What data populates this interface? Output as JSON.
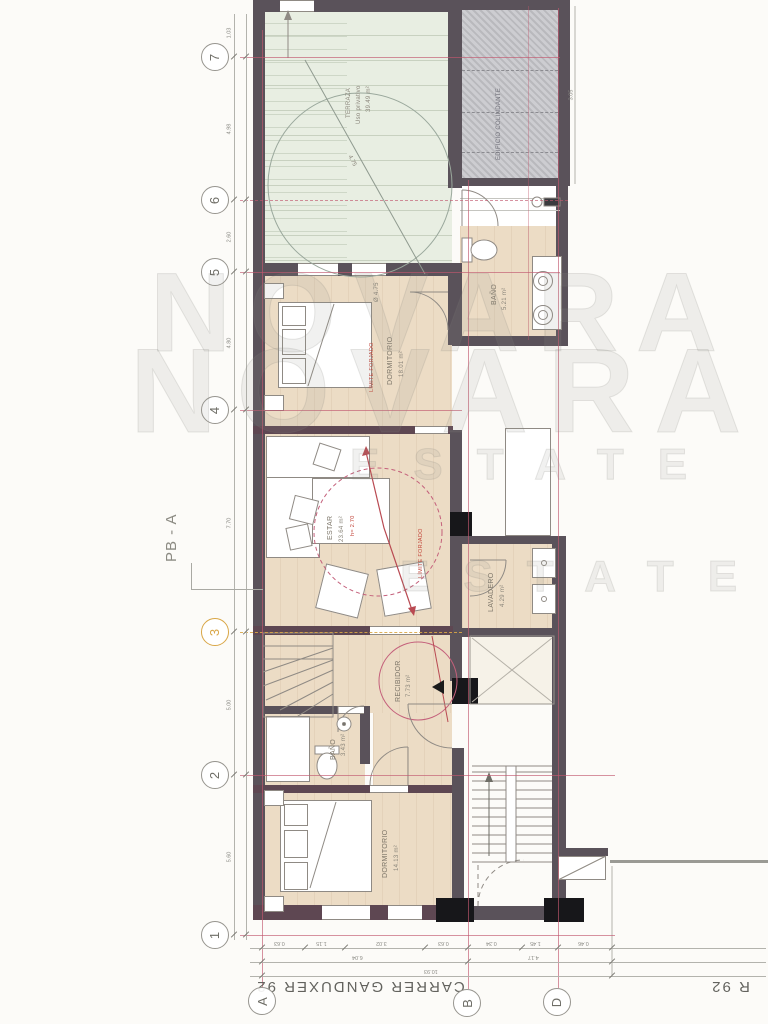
{
  "sheet": {
    "plan_code": "PB - A",
    "street": "CARRER GANDUXER 92",
    "street_fragment": "R 92",
    "watermark_word1": "NOVARA",
    "watermark_word2": "ESTATE"
  },
  "grid": {
    "rows": [
      "7",
      "6",
      "5",
      "4",
      "3",
      "2",
      "1"
    ],
    "cols": [
      "A",
      "B",
      "D"
    ],
    "highlighted_row": "3"
  },
  "rooms": {
    "terraza": {
      "name": "TERRAZA",
      "subtitle": "Uso privativo",
      "area": "39.49 m²"
    },
    "colindante": {
      "name": "EDIFICIO COLINDANTE"
    },
    "bano_sup": {
      "name": "BAÑO",
      "area": "5.21 m²"
    },
    "dormitorio1": {
      "name": "DORMITORIO",
      "area": "18.01 m²"
    },
    "estar": {
      "name": "ESTAR",
      "area": "23.64 m²",
      "note": "h= 2.70"
    },
    "lavadero": {
      "name": "LAVADERO",
      "area": "4.29 m²"
    },
    "recibidor": {
      "name": "RECIBIDOR",
      "area": "7.73 m²"
    },
    "bano_inf": {
      "name": "BAÑO",
      "area": "3.43 m²"
    },
    "dormitorio2": {
      "name": "DORMITORIO",
      "area": "14.13 m²"
    }
  },
  "annotations": {
    "circle_diameter": "4.75",
    "circle_label": "Ø 4.75",
    "red_note_1": "LÍMITE FORJADO",
    "red_note_2": "LÍMITE FORJADO"
  },
  "dimensions": {
    "left": [
      "1.03",
      "4.98",
      "2.60",
      "4.80",
      "7.70",
      "5.00",
      "5.60"
    ],
    "right": [
      "3.05"
    ],
    "bottom_row1": [
      "0.63",
      "1.15",
      "3.02",
      "0.63",
      "0.34",
      "1.45",
      "0.46"
    ],
    "bottom_row2": [
      "6.04",
      "4.17"
    ],
    "bottom_total": "10.93"
  },
  "colors": {
    "wall": "#5a525a",
    "wall_accent": "#5e4752",
    "column": "#17171a",
    "wood_floor": "#ecdcc5",
    "terrace": "#e8eee2",
    "axis_line": "#c1586e",
    "highlight": "#d9a646",
    "red_note": "#c2453a"
  }
}
